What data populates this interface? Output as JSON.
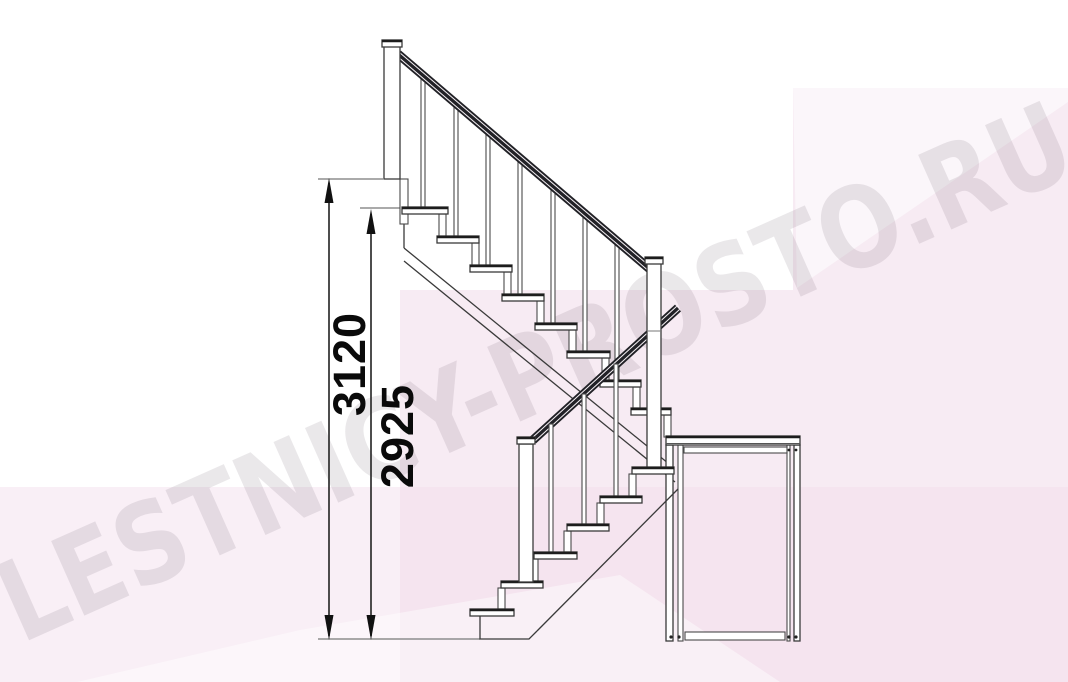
{
  "watermark": {
    "text": "LESTNICY-PROSTO.RU"
  },
  "dimensions": {
    "total": {
      "label": "3120"
    },
    "flight": {
      "label": "2925"
    }
  },
  "colors": {
    "background_pink": "#f8edf4",
    "drawing_line": "#3a3a3a",
    "handrail_dark": "#212126",
    "dimension_text": "#0a0a0a",
    "watermark_gray": "#5c4b60"
  }
}
